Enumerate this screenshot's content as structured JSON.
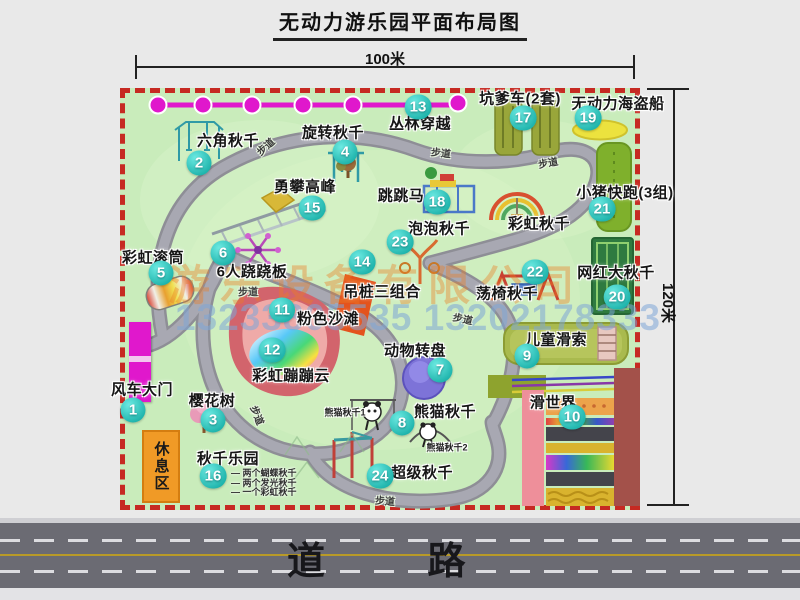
{
  "title": "无动力游乐园平面布局图",
  "dimensions": {
    "width_label": "100米",
    "height_label": "120米"
  },
  "watermark": {
    "company": "游乐设备有限公司",
    "phones": "13233805535 13202178333"
  },
  "road": {
    "label": "道  路"
  },
  "rest_area": {
    "label": "休息区"
  },
  "colors": {
    "map_green": "#c9ecbb",
    "border_red": "#c62a22",
    "path_gray": "#a2a2aa",
    "marker_teal": "#2accc4",
    "magenta": "#e018cc",
    "rest_orange": "#f09a26",
    "road_gray": "#6b6b73",
    "road_yellow": "#b89a28"
  },
  "attractions": [
    {
      "num": "1",
      "name": "风车大门",
      "cx": 133,
      "cy": 410,
      "lx": 142,
      "ly": 389
    },
    {
      "num": "2",
      "name": "六角秋千",
      "cx": 199,
      "cy": 163,
      "lx": 228,
      "ly": 140
    },
    {
      "num": "3",
      "name": "樱花树",
      "cx": 213,
      "cy": 420,
      "lx": 212,
      "ly": 400
    },
    {
      "num": "4",
      "name": "旋转秋千",
      "cx": 345,
      "cy": 152,
      "lx": 333,
      "ly": 132
    },
    {
      "num": "5",
      "name": "彩虹滚筒",
      "cx": 161,
      "cy": 273,
      "lx": 153,
      "ly": 257
    },
    {
      "num": "6",
      "name": "6人跷跷板",
      "cx": 223,
      "cy": 253,
      "lx": 252,
      "ly": 271
    },
    {
      "num": "7",
      "name": "动物转盘",
      "cx": 440,
      "cy": 370,
      "lx": 415,
      "ly": 350
    },
    {
      "num": "8",
      "name": "熊猫秋千",
      "cx": 402,
      "cy": 423,
      "lx": 445,
      "ly": 411
    },
    {
      "num": "9",
      "name": "儿童滑索",
      "cx": 527,
      "cy": 356,
      "lx": 556,
      "ly": 339
    },
    {
      "num": "10",
      "name": "滑世界",
      "cx": 572,
      "cy": 417,
      "lx": 553,
      "ly": 402
    },
    {
      "num": "11",
      "name": "粉色沙滩",
      "cx": 282,
      "cy": 310,
      "lx": 328,
      "ly": 318
    },
    {
      "num": "12",
      "name": "彩虹蹦蹦云",
      "cx": 272,
      "cy": 350,
      "lx": 291,
      "ly": 375
    },
    {
      "num": "13",
      "name": "丛林穿越",
      "cx": 418,
      "cy": 107,
      "lx": 420,
      "ly": 123
    },
    {
      "num": "14",
      "name": "吊桩三组合",
      "cx": 362,
      "cy": 262,
      "lx": 382,
      "ly": 291
    },
    {
      "num": "15",
      "name": "勇攀高峰",
      "cx": 312,
      "cy": 208,
      "lx": 305,
      "ly": 186
    },
    {
      "num": "16",
      "name": "秋千乐园",
      "cx": 213,
      "cy": 476,
      "lx": 228,
      "ly": 458
    },
    {
      "num": "17",
      "name": "坑爹车(2套)",
      "cx": 523,
      "cy": 118,
      "lx": 520,
      "ly": 98
    },
    {
      "num": "18",
      "name": "跳跳马",
      "cx": 437,
      "cy": 202,
      "lx": 401,
      "ly": 195
    },
    {
      "num": "19",
      "name": "无动力海盗船",
      "cx": 588,
      "cy": 118,
      "lx": 618,
      "ly": 103
    },
    {
      "num": "20",
      "name": "网红大秋千",
      "cx": 617,
      "cy": 297,
      "lx": 616,
      "ly": 272
    },
    {
      "num": "21",
      "name": "小猪快跑(3组)",
      "cx": 602,
      "cy": 209,
      "lx": 625,
      "ly": 192
    },
    {
      "num": "22",
      "name": "荡椅秋千",
      "cx": 535,
      "cy": 272,
      "lx": 507,
      "ly": 293
    },
    {
      "num": "23",
      "name": "泡泡秋千",
      "cx": 400,
      "cy": 242,
      "lx": 439,
      "ly": 228
    },
    {
      "num": "24",
      "name": "超级秋千",
      "cx": 380,
      "cy": 476,
      "lx": 422,
      "ly": 472
    },
    {
      "num": null,
      "name": "彩虹秋千",
      "cx": 0,
      "cy": 0,
      "lx": 539,
      "ly": 223
    }
  ],
  "sub_labels": [
    {
      "text": "熊猫秋千1",
      "x": 345,
      "y": 412
    },
    {
      "text": "熊猫秋千2",
      "x": 447,
      "y": 447
    }
  ],
  "swing_park_notes": [
    "两个蝴蝶秋千",
    "两个发光秋千",
    "一个彩虹秋千"
  ],
  "path_labels": [
    {
      "text": "步道",
      "x": 265,
      "y": 146,
      "rot": -42
    },
    {
      "text": "步道",
      "x": 441,
      "y": 152,
      "rot": 6
    },
    {
      "text": "步道",
      "x": 548,
      "y": 162,
      "rot": -10
    },
    {
      "text": "步道",
      "x": 248,
      "y": 291,
      "rot": 0
    },
    {
      "text": "步道",
      "x": 258,
      "y": 415,
      "rot": 68
    },
    {
      "text": "步道",
      "x": 463,
      "y": 318,
      "rot": 12
    },
    {
      "text": "步道",
      "x": 385,
      "y": 500,
      "rot": 4
    }
  ]
}
